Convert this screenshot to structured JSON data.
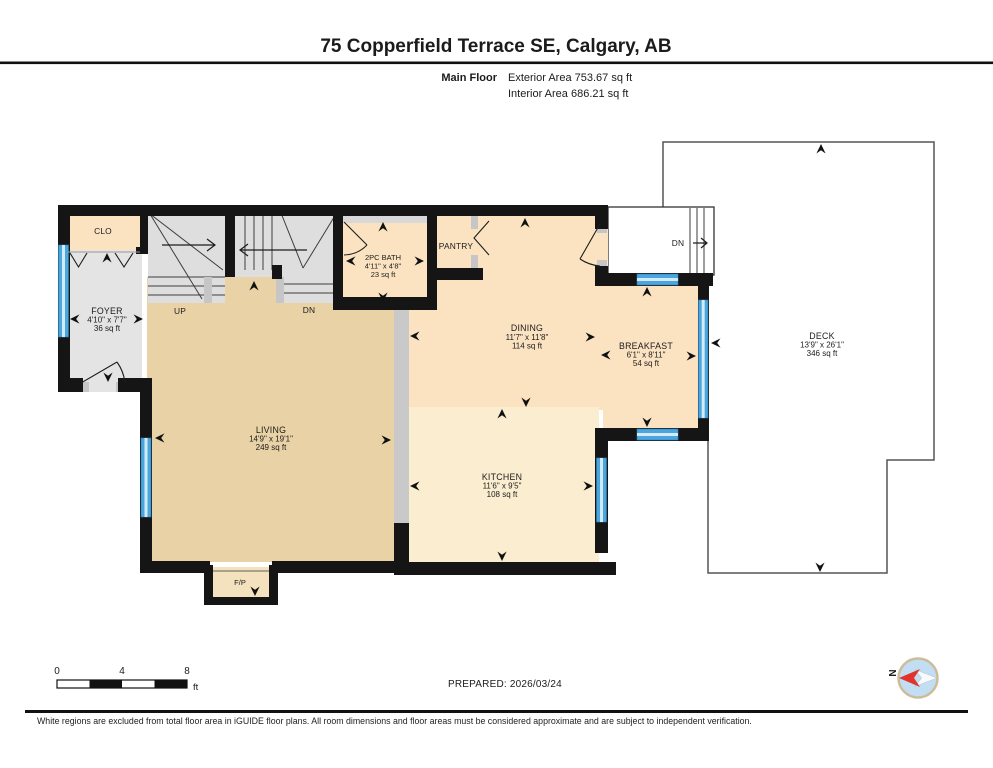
{
  "header": {
    "title": "75 Copperfield Terrace SE, Calgary, AB",
    "floor_label": "Main Floor",
    "exterior_area": "Exterior Area 753.67 sq ft",
    "interior_area": "Interior Area 686.21 sq ft"
  },
  "rooms": {
    "clo": {
      "name": "CLO"
    },
    "foyer": {
      "name": "FOYER",
      "dims": "4'10\" x 7'7\"",
      "area": "36 sq ft"
    },
    "stairs_up": {
      "label": "UP"
    },
    "stairs_dn": {
      "label": "DN"
    },
    "deck_stairs": {
      "label": "DN"
    },
    "bath": {
      "name": "2PC BATH",
      "dims": "4'11\" x 4'8\"",
      "area": "23 sq ft"
    },
    "pantry": {
      "name": "PANTRY"
    },
    "dining": {
      "name": "DINING",
      "dims": "11'7\" x 11'8\"",
      "area": "114 sq ft"
    },
    "breakfast": {
      "name": "BREAKFAST",
      "dims": "6'1\" x 8'11\"",
      "area": "54 sq ft"
    },
    "living": {
      "name": "LIVING",
      "dims": "14'9\" x 19'1\"",
      "area": "249 sq ft"
    },
    "kitchen": {
      "name": "KITCHEN",
      "dims": "11'6\" x 9'5\"",
      "area": "108 sq ft"
    },
    "deck": {
      "name": "DECK",
      "dims": "13'9\" x 26'1\"",
      "area": "346 sq ft"
    },
    "fireplace": {
      "name": "F/P"
    }
  },
  "scale_bar": {
    "tick0": "0",
    "tick4": "4",
    "tick8": "8",
    "unit": "ft"
  },
  "compass": {
    "north_label": "N"
  },
  "footer": {
    "prepared": "PREPARED: 2026/03/24",
    "disclaimer": "White regions are excluded from total floor area in iGUIDE floor plans. All room dimensions and floor areas must be considered approximate and are subject to independent verification."
  },
  "colors": {
    "wall": "#151515",
    "window_blue": "#4aa6dc",
    "floor_peach": "#fbe3c2",
    "floor_tan": "#e9d2a6",
    "floor_cream": "#fbeed0",
    "floor_gray": "#e4e4e4",
    "stair_gray": "#dedede",
    "deck_outline": "#555555",
    "compass_red": "#e2342b",
    "compass_blue": "#c2def2"
  }
}
